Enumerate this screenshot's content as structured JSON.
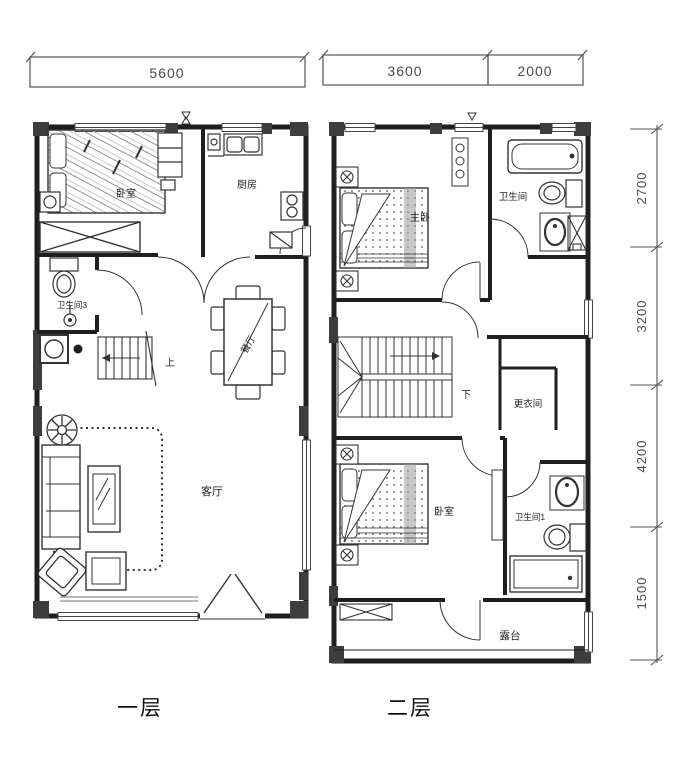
{
  "colors": {
    "background": "#ffffff",
    "wall": "#1f1f1f",
    "pier": "#3d3d3d",
    "furniture_line": "#333333",
    "dimension_line": "#555555",
    "dimension_text": "#4a4a4a"
  },
  "dimensions": {
    "floor1_top": "5600",
    "floor2_top": [
      "3600",
      "2000"
    ],
    "floor2_right": [
      "2700",
      "3200",
      "4200",
      "1500"
    ]
  },
  "floor1": {
    "caption": "一层",
    "labels": {
      "bedroom": "卧室",
      "kitchen": "厨房",
      "bathroom": "卫生间3",
      "stairs_up": "上",
      "dining": "餐厅",
      "living": "客厅"
    }
  },
  "floor2": {
    "caption": "二层",
    "labels": {
      "master_bedroom": "主卧",
      "bathroom_top": "卫生间",
      "stairs_down": "下",
      "dressing": "更衣间",
      "bedroom": "卧室",
      "bathroom_bottom": "卫生间1",
      "terrace": "露台"
    }
  }
}
